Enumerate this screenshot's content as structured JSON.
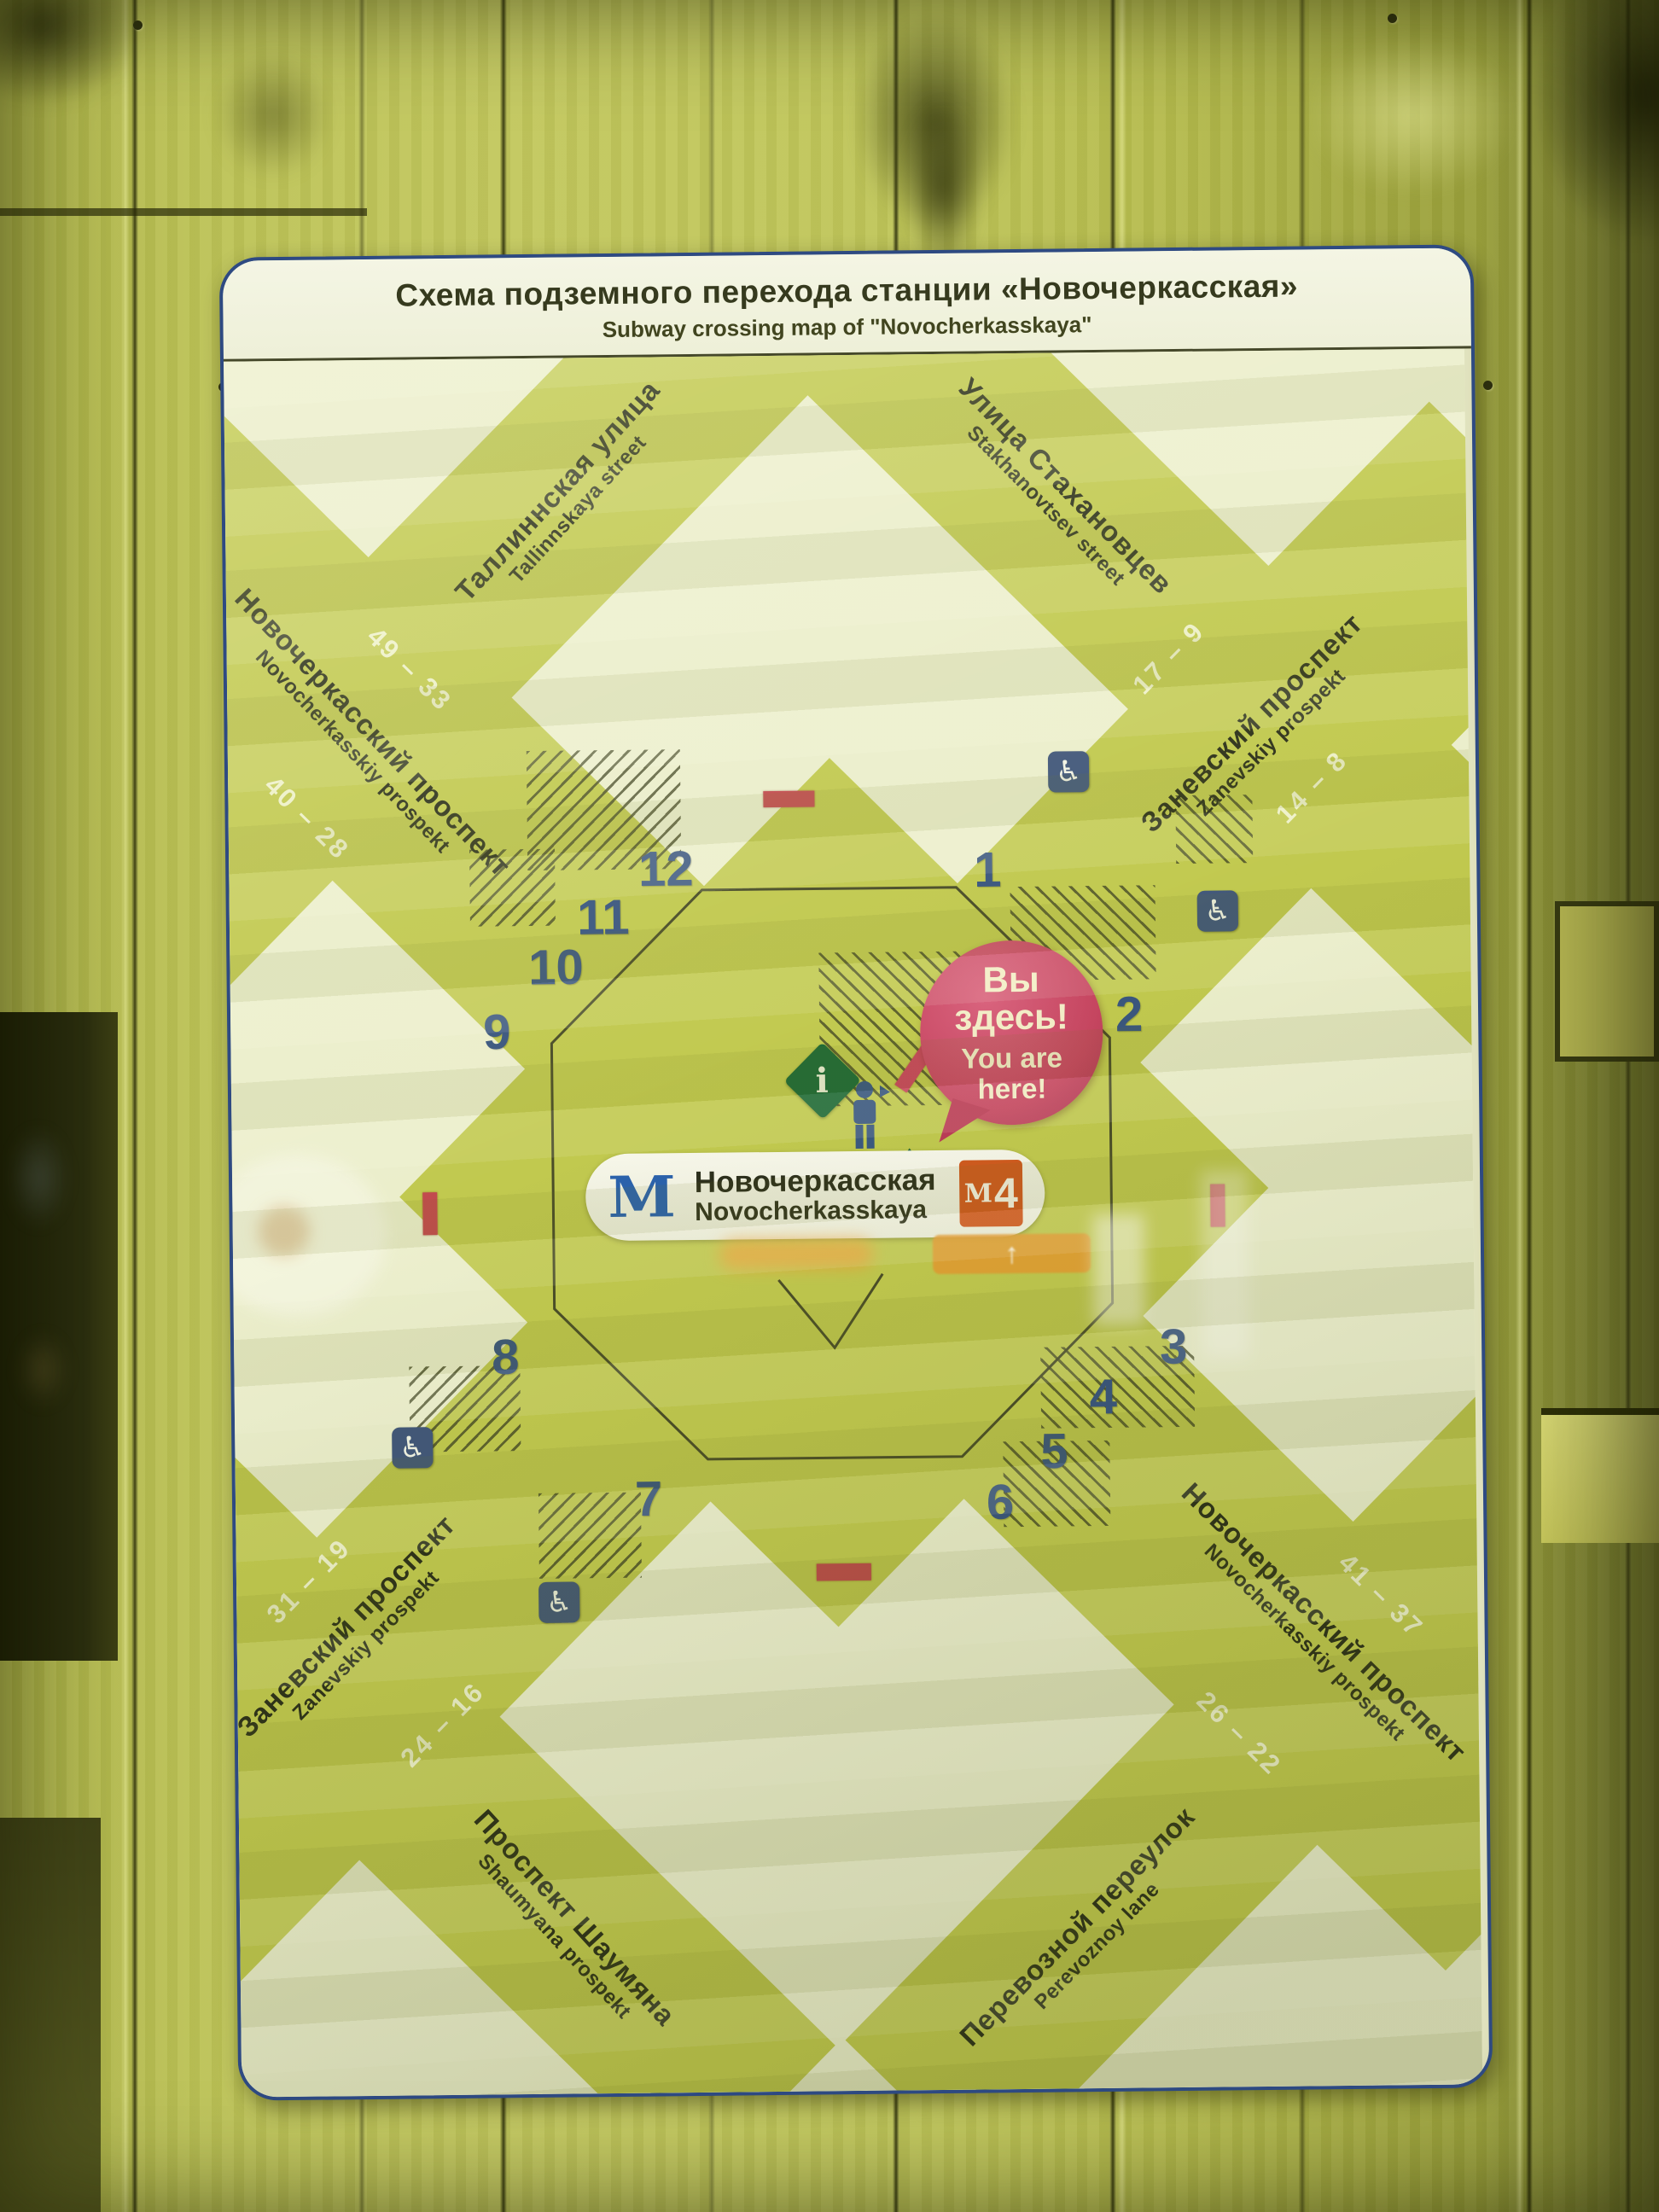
{
  "sign": {
    "title_ru": "Схема подземного перехода станции «Новочеркасская»",
    "title_en": "Subway crossing map of \"Novocherkasskaya\""
  },
  "station": {
    "metro_logo": "М",
    "name_ru": "Новочеркасская",
    "name_en": "Novocherkasskaya",
    "line_badge_m": "М",
    "line_badge_num": "4"
  },
  "you_are_here": {
    "ru_1": "Вы",
    "ru_2": "здесь!",
    "en_1": "You are",
    "en_2": "here!"
  },
  "streets": {
    "tallinnskaya": {
      "ru": "Таллиннская улица",
      "en": "Tallinnskaya street"
    },
    "stakhanovtsev": {
      "ru": "Улица Стахановцев",
      "en": "Stakhanovtsev street"
    },
    "novocherkasskiy_nw": {
      "ru": "Новочеркасский проспект",
      "en": "Novocherkasskiy prospekt"
    },
    "zanevskiy_ne": {
      "ru": "Заневский проспект",
      "en": "Zanevskiy prospekt"
    },
    "zanevskiy_sw": {
      "ru": "Заневский проспект",
      "en": "Zanevskiy prospekt"
    },
    "novocherkasskiy_se": {
      "ru": "Новочеркасский проспект",
      "en": "Novocherkasskiy prospekt"
    },
    "shaumyana": {
      "ru": "Проспект Шаумяна",
      "en": "Shaumyana prospekt"
    },
    "perevoznoy": {
      "ru": "Перевозной переулок",
      "en": "Perevoznoy lane"
    }
  },
  "house_numbers": [
    "49 – 33",
    "40 – 28",
    "17 – 9",
    "14 – 8",
    "31 – 19",
    "24 – 16",
    "41 – 37",
    "26 – 22"
  ],
  "exits": [
    "1",
    "2",
    "3",
    "4",
    "5",
    "6",
    "7",
    "8",
    "9",
    "10",
    "11",
    "12"
  ],
  "icons": {
    "info": "i",
    "wheelchair": "♿",
    "arrow_up": "↑"
  },
  "colors": {
    "wall_olive": "#b5bb4e",
    "sign_cream": "#edefd0",
    "street_green": "#c1c94f",
    "exit_navy": "#3a567e",
    "bubble_pink": "#c64560",
    "dash_red": "#c24b4e",
    "badge_orange": "#d05a1e",
    "metro_blue": "#2b62ac",
    "info_green": "#1f6a36",
    "wheelchair_navy": "#42587a"
  }
}
